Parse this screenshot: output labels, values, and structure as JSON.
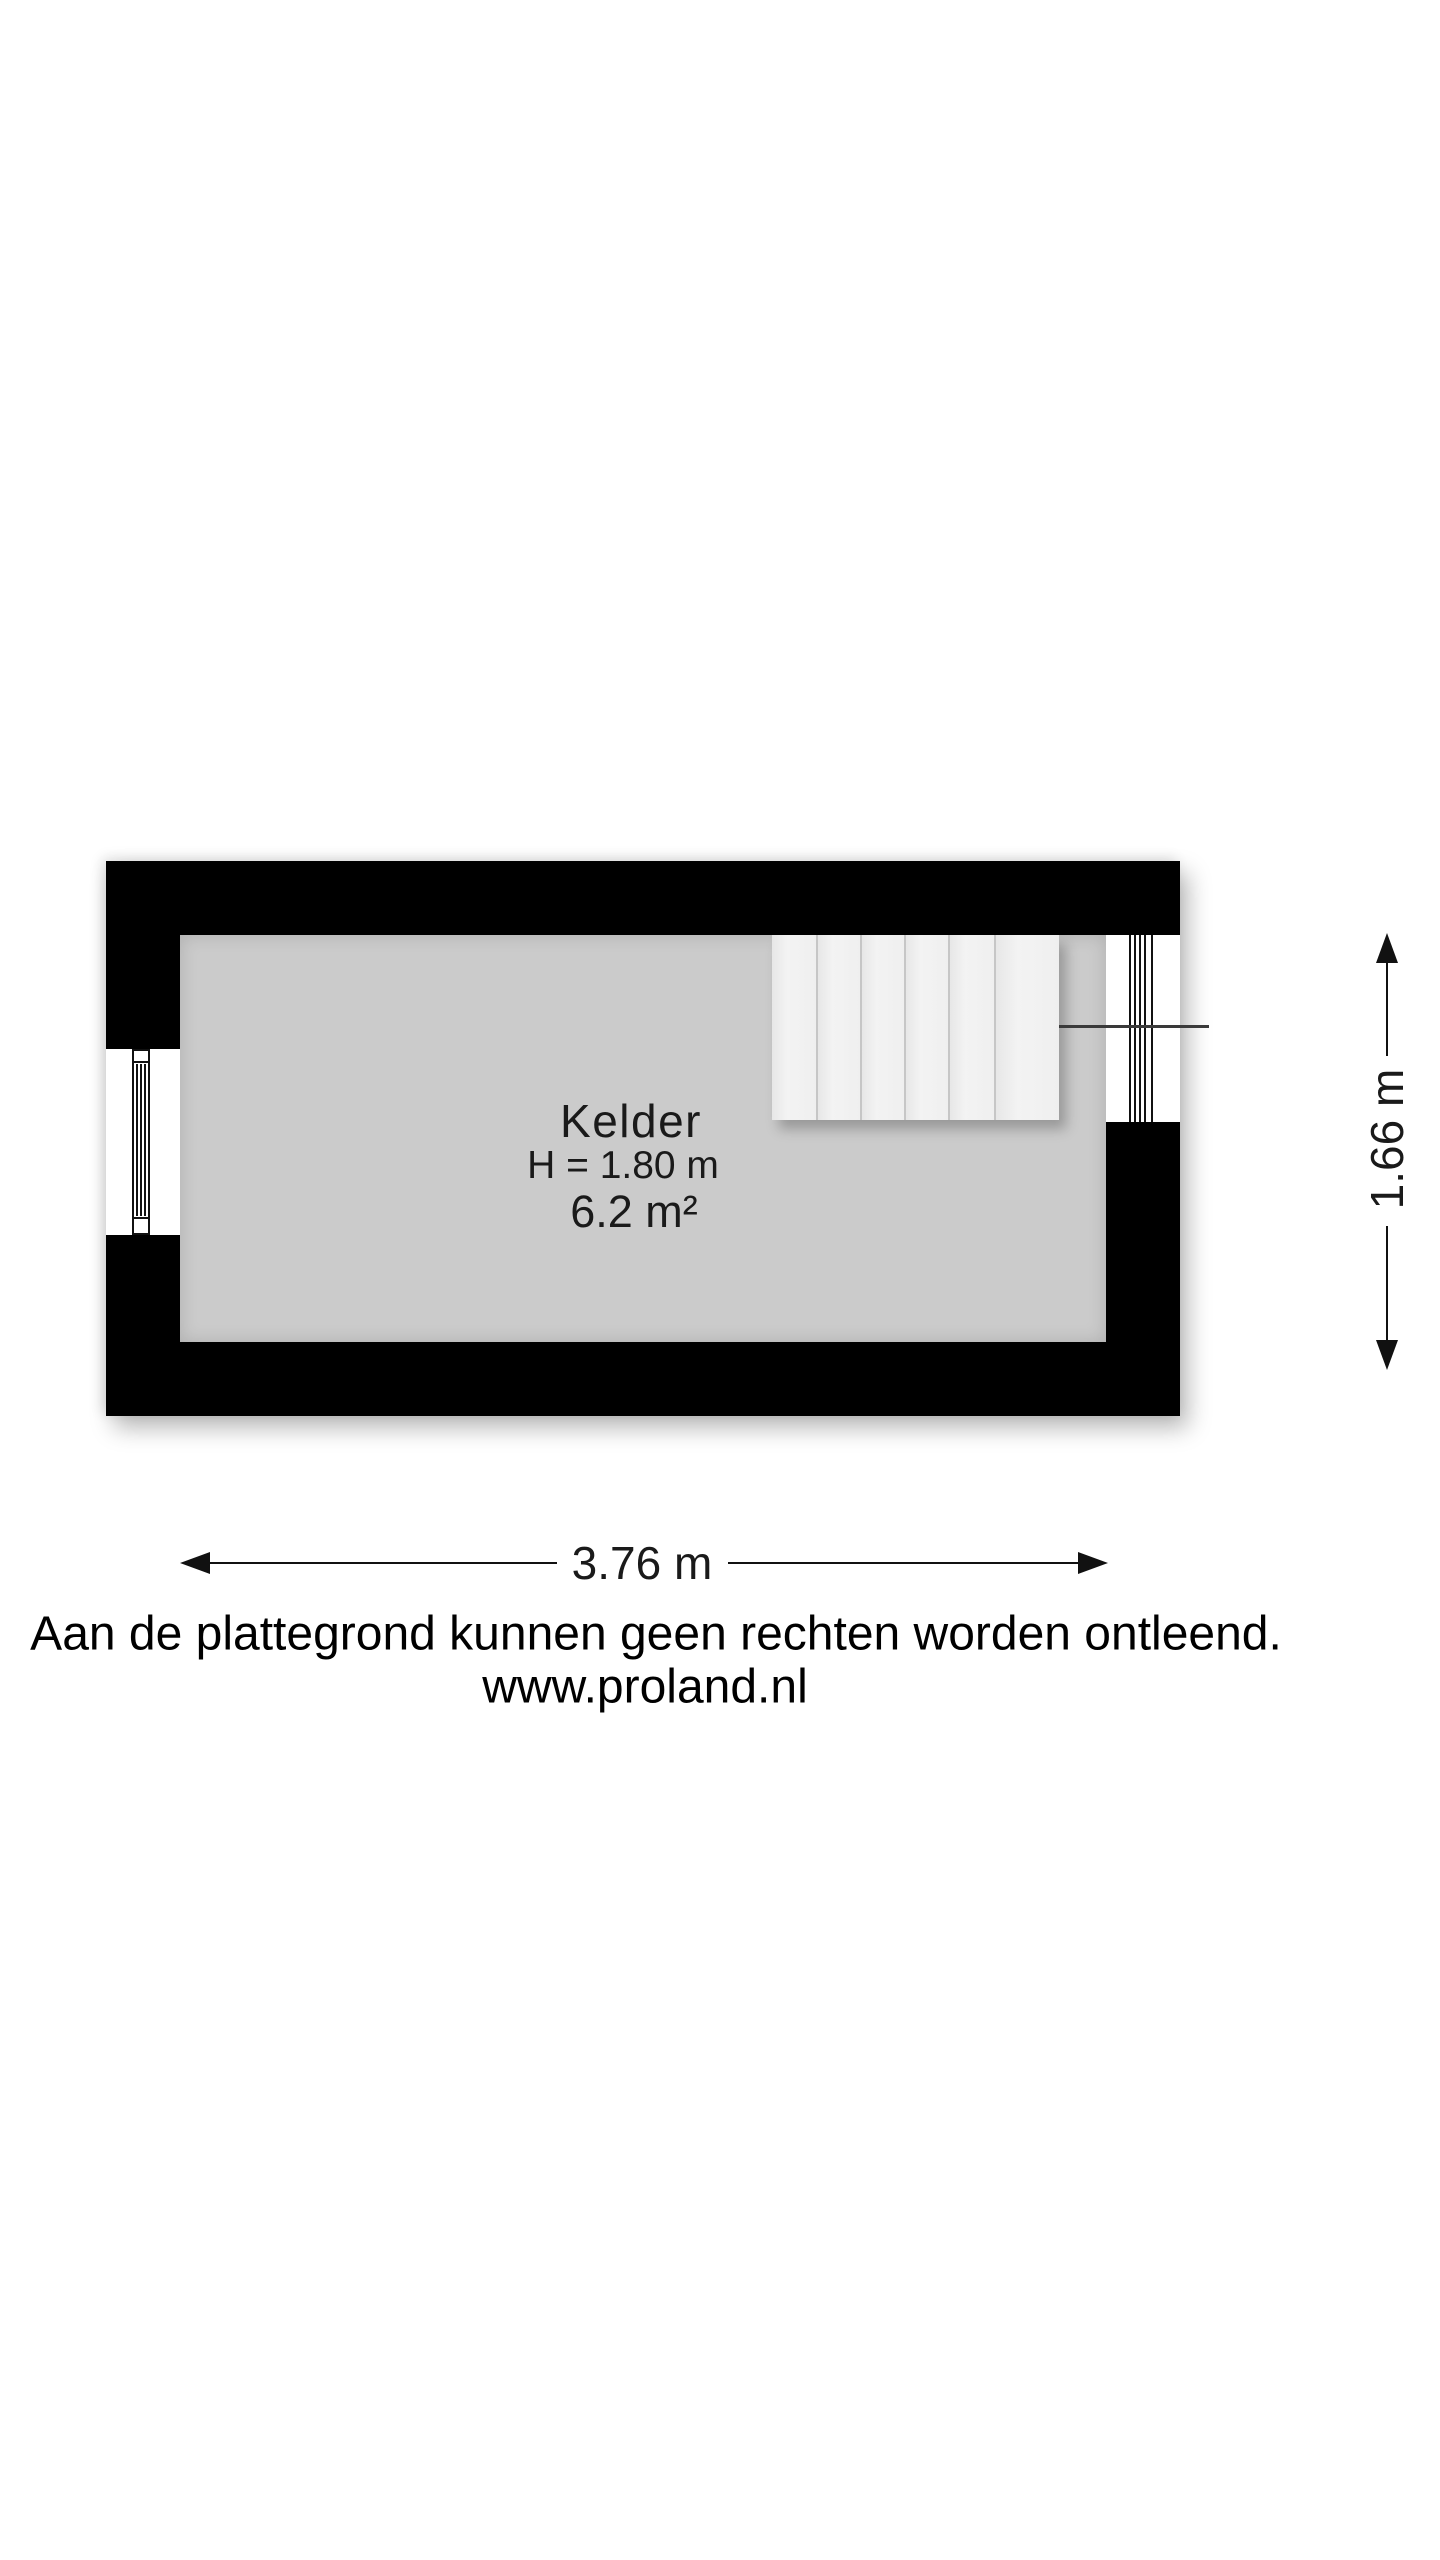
{
  "plan": {
    "room_name": "Kelder",
    "room_height_label": "H = 1.80 m",
    "room_area_label": "6.2 m²",
    "stairs": {
      "tread_count": 6
    }
  },
  "dimensions": {
    "width_label": "3.76 m",
    "height_label": "1.66 m"
  },
  "footer": {
    "disclaimer": "Aan de plattegrond kunnen geen rechten worden ontleend.",
    "website": "www.proland.nl"
  },
  "colors": {
    "wall": "#000000",
    "floor": "#cbcbcb",
    "stair_tread": "#f0f0f0",
    "window": "#ffffff",
    "ink": "#111111",
    "walkline": "#3a3a3a",
    "background": "#ffffff"
  }
}
